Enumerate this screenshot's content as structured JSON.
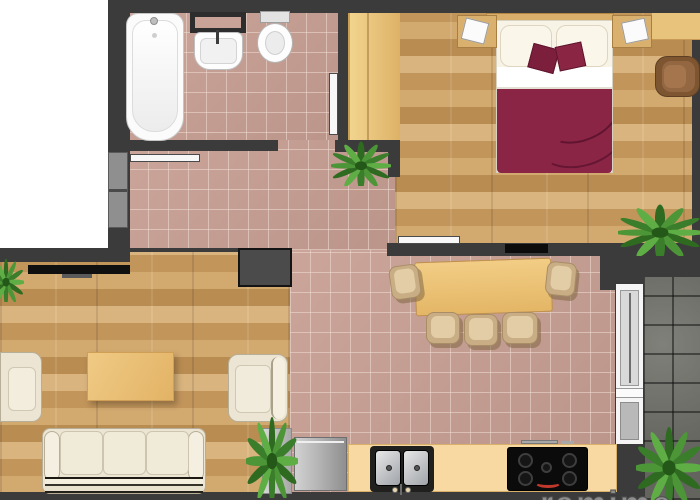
{
  "watermark": {
    "text": "ramime"
  },
  "palette": {
    "wall": "#3b3b3b",
    "tile": "#c79e92",
    "wood": "#c79a5f",
    "stone": "#72726c",
    "counter": "#f8d9a2",
    "cabinet_wood": "#e8c37c",
    "duvet": "#8b2546",
    "accent_pillow": "#7c1f3c",
    "upholstery_cream": "#ece5d4",
    "armchair_brown": "#7d5531",
    "appliance_black": "#0b0b0b",
    "fridge_silver": "#b5b5b5",
    "door_leaf": "#f7f7f7",
    "entry_door_gray": "#8f8f8f",
    "plant_green": "#3f8a2e"
  },
  "fixtures": [
    "bathtub",
    "sink",
    "toilet",
    "mirror-cabinet",
    "wardrobe",
    "double-bed",
    "nightstand",
    "table-lamp",
    "desk",
    "armchair",
    "tv",
    "dining-table",
    "dining-chair",
    "sofa",
    "coffee-table",
    "refrigerator",
    "kitchen-sink",
    "cooktop",
    "balcony-door",
    "potted-plant"
  ]
}
